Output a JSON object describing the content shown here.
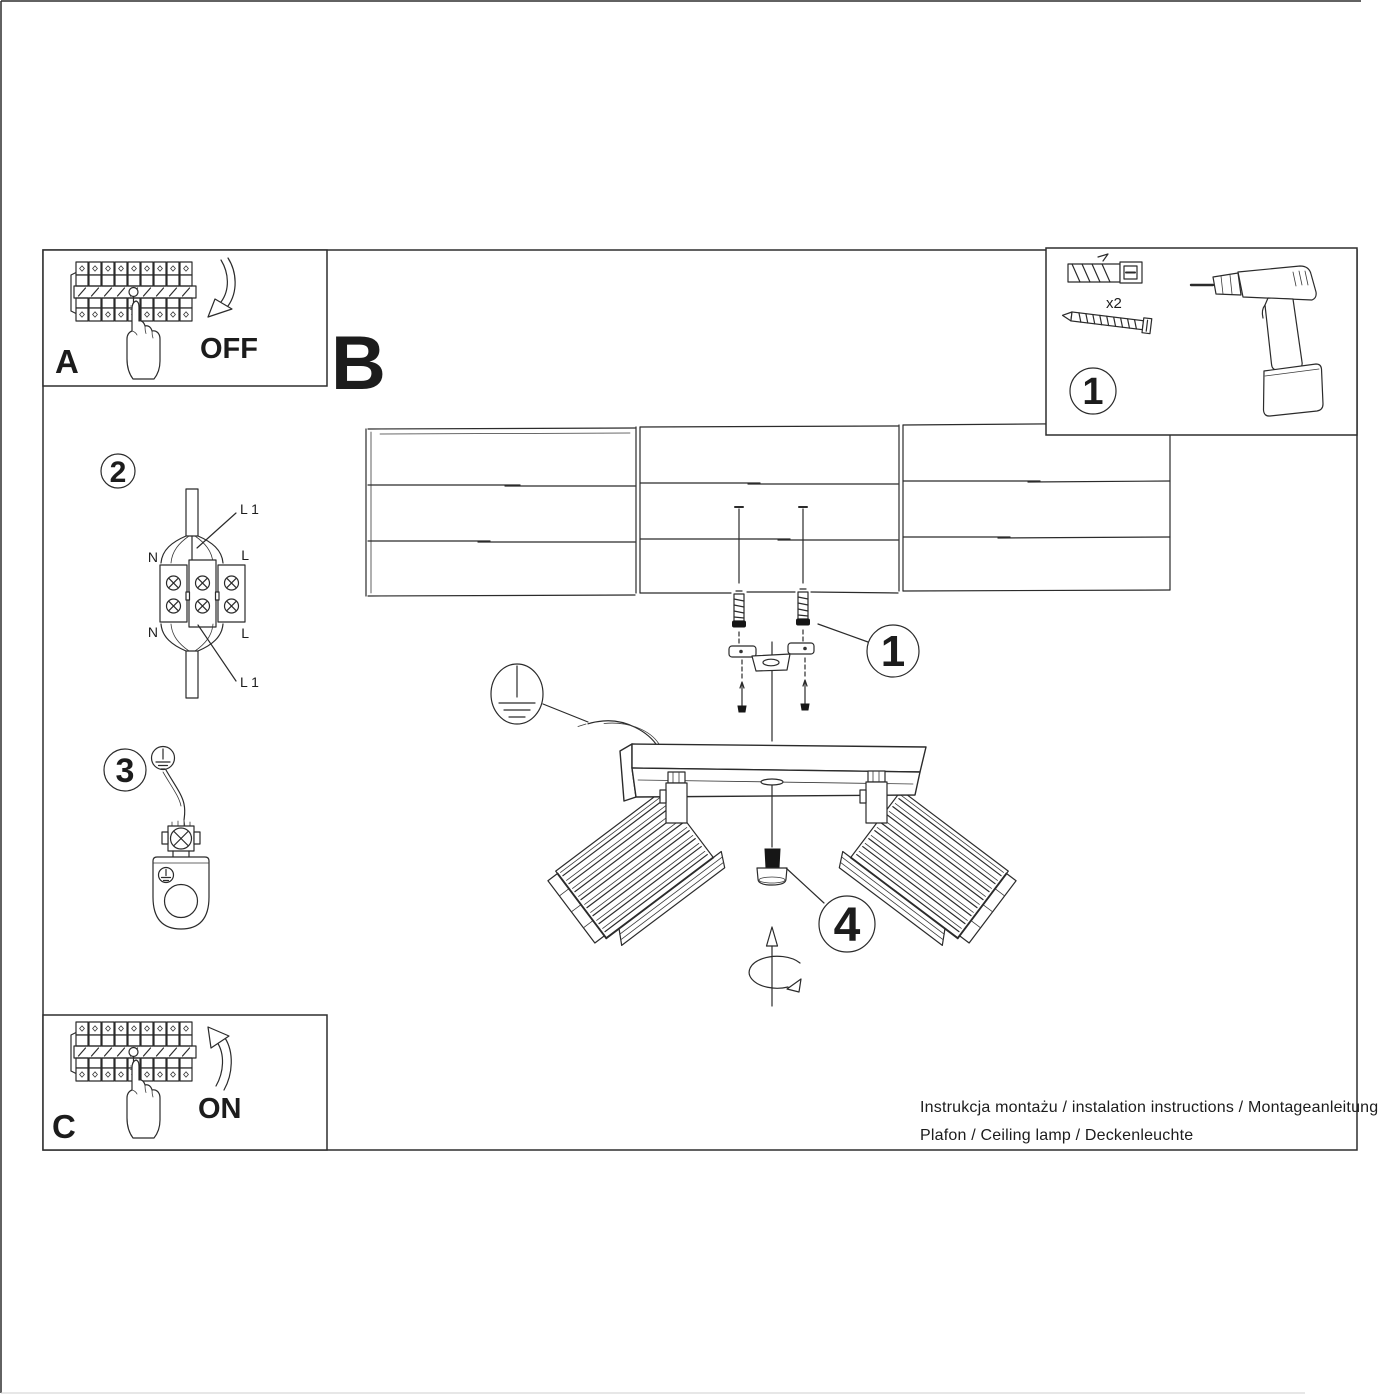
{
  "page": {
    "footer_line1": "Instrukcja montażu / instalation instructions / Montageanleitung",
    "footer_line2": "Plafon / Ceiling lamp / Deckenleuchte"
  },
  "sections": {
    "a_label": "A",
    "a_action": "OFF",
    "b_label": "B",
    "c_label": "C",
    "c_action": "ON"
  },
  "steps": {
    "s1_number": "1",
    "s1_qty": "x2",
    "s2_number": "2",
    "s3_number": "3",
    "s4_number": "4",
    "callout_bracket": "1"
  },
  "wiring": {
    "l1_top": "L 1",
    "n_top": "N",
    "l_top": "L",
    "n_bottom": "N",
    "l_bottom": "L",
    "l1_bottom": "L 1"
  },
  "colors": {
    "line": "#2b2b2b",
    "text": "#1c1c1c"
  }
}
